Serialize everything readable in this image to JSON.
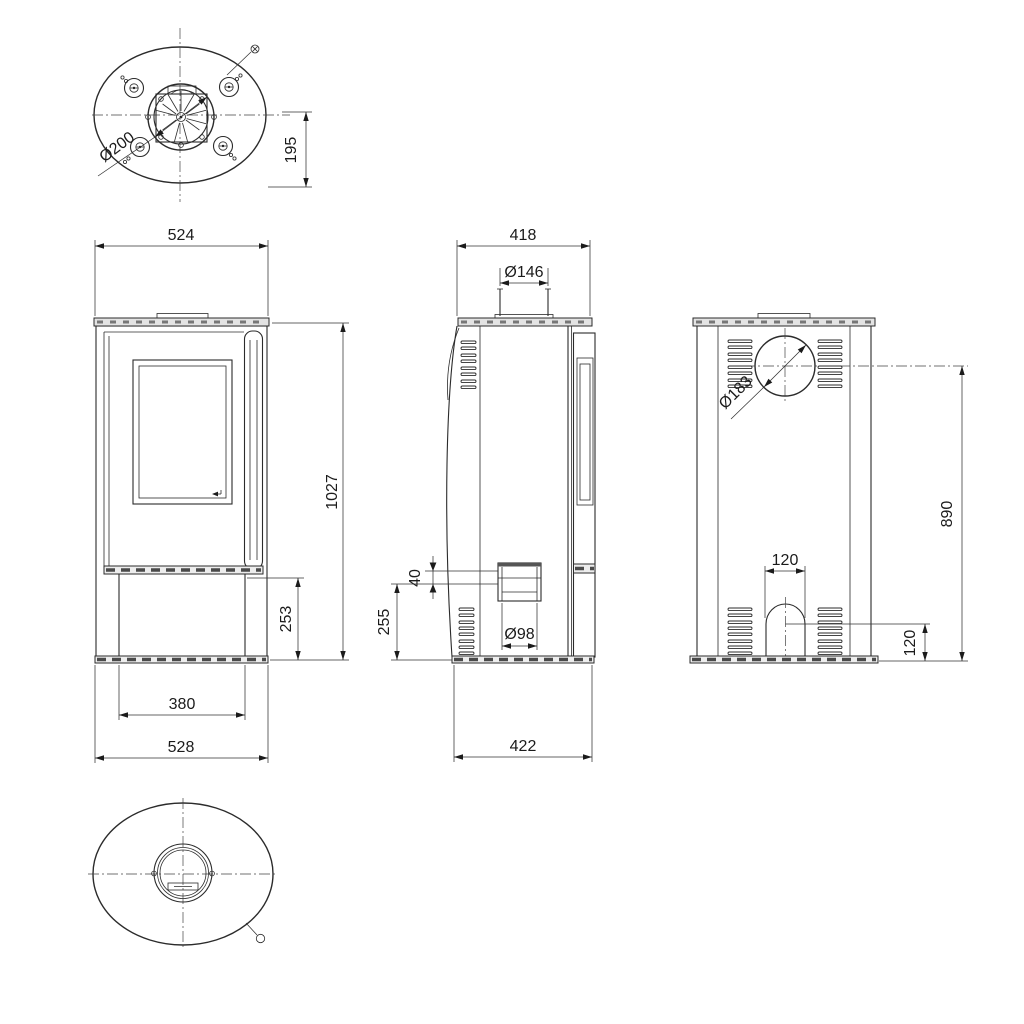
{
  "drawing": {
    "type": "technical-drawing",
    "subject": "oval free-standing stove, orthographic views with dimensions (mm)",
    "colors": {
      "line": "#2b2b2b",
      "plate_fill": "#e3e3e3",
      "background": "#ffffff"
    },
    "views": {
      "top": {
        "dims": {
          "flue_diameter": "Ø200",
          "flue_center_to_rear": "195"
        }
      },
      "front": {
        "dims": {
          "top_width": "524",
          "overall_height": "1027",
          "plinth_height": "253",
          "base_inner_width": "380",
          "base_width": "528"
        }
      },
      "side": {
        "dims": {
          "top_depth": "418",
          "flue_collar_diameter": "Ø146",
          "air_inlet_duct_height": "40",
          "air_inlet_center_height": "255",
          "air_inlet_diameter": "Ø98",
          "base_depth": "422"
        }
      },
      "back": {
        "dims": {
          "flue_outlet_diameter": "Ø183",
          "flue_center_height": "890",
          "arch_width": "120",
          "arch_center_height": "120"
        }
      },
      "bottom": {
        "dims": {}
      }
    }
  }
}
